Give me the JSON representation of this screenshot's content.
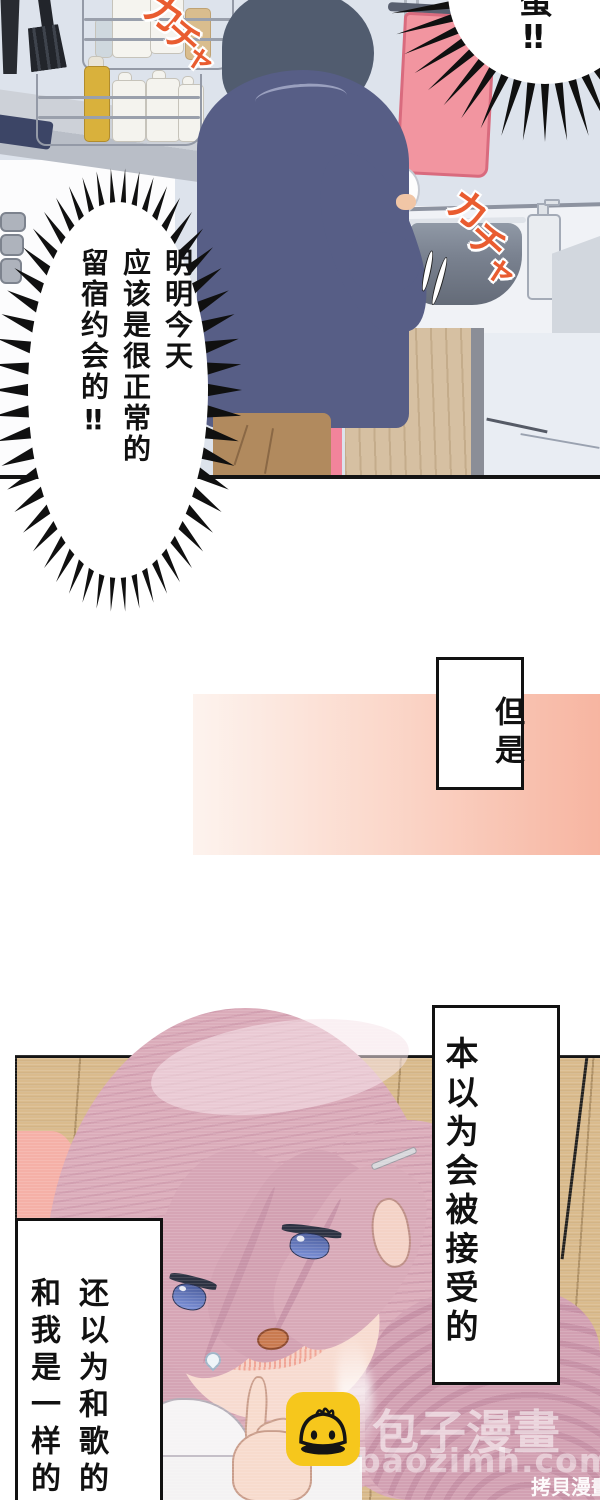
{
  "kitchen": {
    "sfx_shelf": {
      "text": "カチャ",
      "chars": [
        "カ",
        "チ",
        "ャ"
      ]
    },
    "sfx_sink": {
      "text": "カチャ",
      "chars": [
        "カ",
        "チ",
        "ャ"
      ]
    },
    "shout_bubble_top": {
      "text": "蛋‼"
    },
    "shout_bubble_main": {
      "columns": [
        "明明今天",
        "应该是很正常的",
        "留宿约会的‼"
      ]
    }
  },
  "transition": {
    "caption": "但是"
  },
  "girl": {
    "caption_right": "本以为会被接受的",
    "caption_left_columns": [
      "还以为和歌的",
      "和我是一样的"
    ]
  },
  "watermarks": {
    "brand": "包子漫畫",
    "site": "baozimh.com",
    "corner": "拷貝漫畫網",
    "icon": "baozi-mascot"
  },
  "palette": {
    "sfx_orange": "#e95c30",
    "towel_pink": "#f295a0",
    "band_start": "#fdf3ee",
    "band_end": "#f7b5a1",
    "sweater_navy": "#575e86",
    "boy_hair": "#515c6f",
    "girl_hair": "#dbacba",
    "wood": "#dabb8d",
    "baozi_yellow": "#f6c71c"
  }
}
